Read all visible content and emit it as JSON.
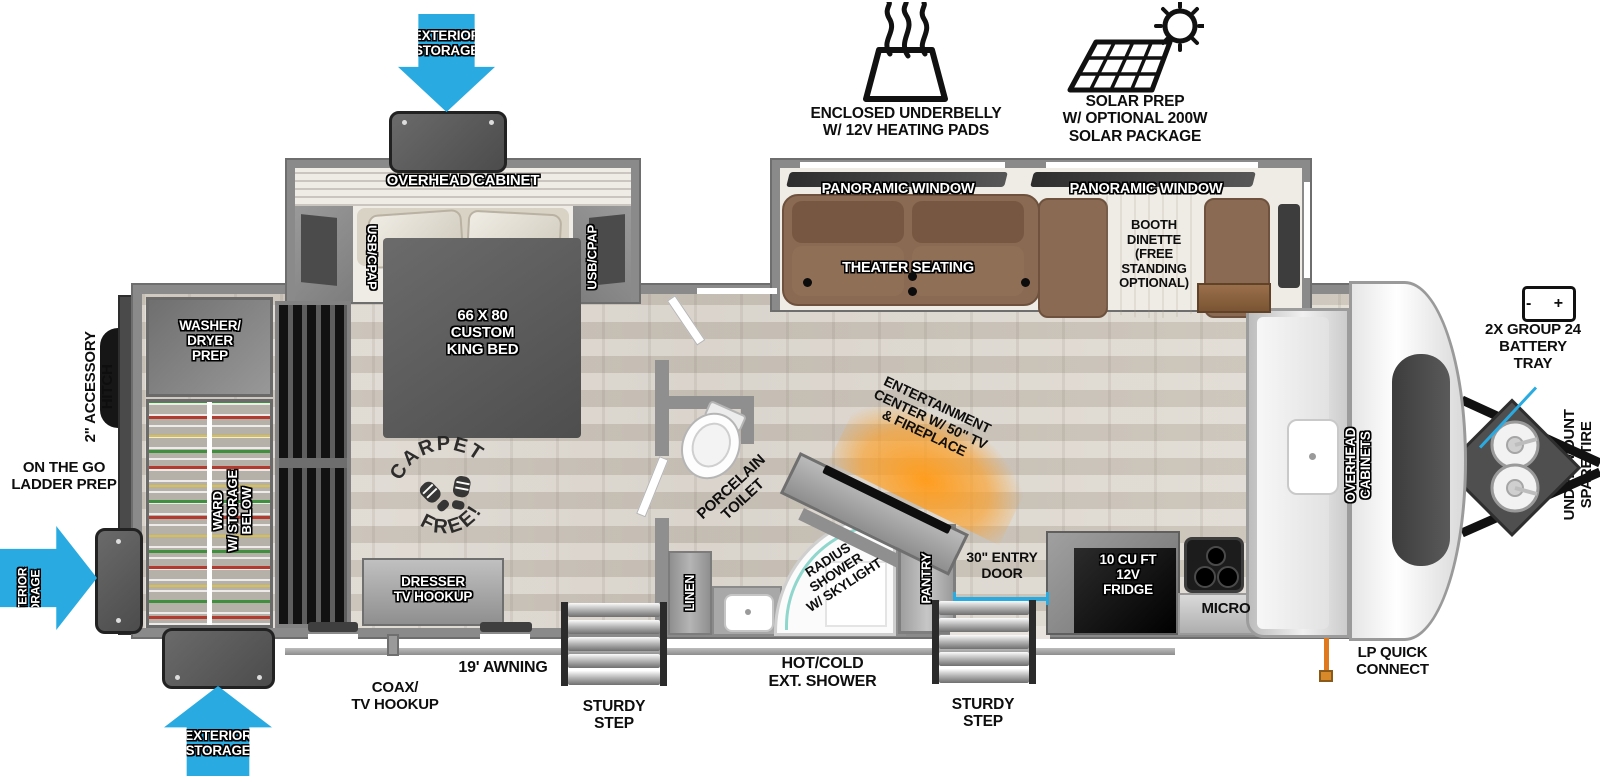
{
  "colors": {
    "arrow_blue": "#29abe2",
    "fireplace_orange": "#f7941e",
    "lp_orange": "#e0781e",
    "door_line_blue": "#29abe2"
  },
  "icons": {
    "heat_icon": "enclosed-underbelly-heating-pads",
    "solar_icon": "solar-panel-with-sun",
    "battery_icon": "battery",
    "carpet_free_stamp": "boot-prints"
  },
  "exterior": {
    "exterior_storage": "EXTERIOR\nSTORAGE",
    "enclosed_underbelly": "ENCLOSED UNDERBELLY\nW/ 12V HEATING PADS",
    "solar_prep": "SOLAR PREP\nW/ OPTIONAL 200W\nSOLAR PACKAGE",
    "battery_tray": "2X GROUP 24\nBATTERY\nTRAY",
    "battery_icon_text": "-   +",
    "under_mount_spare_tire": "UNDER-MOUNT\nSPARE TIRE",
    "accessory_hitch": "2\" ACCESSORY\nHITCH",
    "ladder_prep": "ON THE GO\nLADDER PREP",
    "coax_tv_hookup": "COAX/\nTV HOOKUP",
    "awning": "19' AWNING",
    "sturdy_step": "STURDY\nSTEP",
    "ext_shower": "HOT/COLD\nEXT. SHOWER",
    "entry_door": "30\" ENTRY\nDOOR",
    "lp_quick_connect": "LP QUICK\nCONNECT"
  },
  "interior": {
    "overhead_cabinet": "OVERHEAD CABINET",
    "usb_cpap": "USB/CPAP",
    "panoramic_window": "PANORAMIC WINDOW",
    "theater_seating": "THEATER SEATING",
    "booth_dinette": "BOOTH\nDINETTE\n(FREE\nSTANDING\nOPTIONAL)",
    "king_bed": "66 X 80\nCUSTOM\nKING BED",
    "washer_dryer_prep": "WASHER/\nDRYER\nPREP",
    "ward": "WARD\nW/ STORAGE\nBELOW",
    "dresser": "DRESSER\nTV HOOKUP",
    "carpet_free_top": "CARPET",
    "carpet_free_bottom": "FREE!",
    "porcelain_toilet": "PORCELAIN\nTOILET",
    "linen": "LINEN",
    "radius_shower": "RADIUS\nSHOWER\nW/ SKYLIGHT",
    "entertainment": "ENTERTAINMENT\nCENTER W/ 50\" TV\n& FIREPLACE",
    "pantry": "PANTRY",
    "fridge": "10 CU FT\n12V\nFRIDGE",
    "micro": "MICRO",
    "overhead_cabinets": "OVERHEAD\nCABINETS"
  }
}
